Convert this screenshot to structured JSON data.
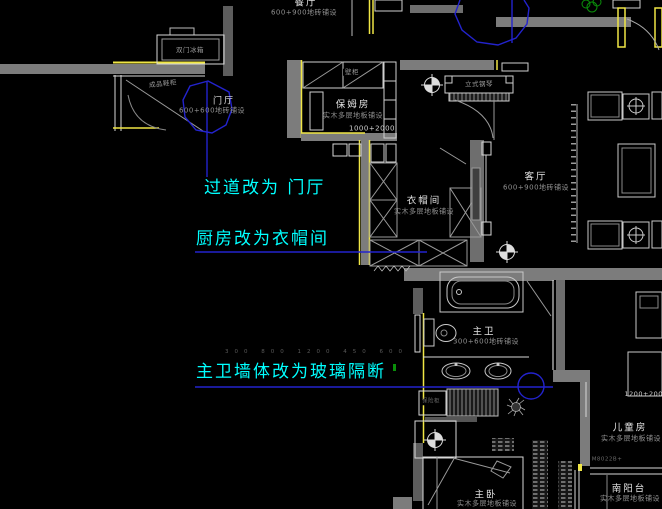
{
  "colors": {
    "background": "#000000",
    "wall_gray": "#7c7c7c",
    "line_white": "#d9d9d9",
    "accent_yellow": "#f0e645",
    "annotation_cyan": "#00ffff",
    "leader_blue": "#2323cd",
    "plant_green": "#0a8f0a"
  },
  "annotations": {
    "corridor_note": "过道改为 门厅",
    "kitchen_note": "厨房改为衣帽间",
    "bath_note": "主卫墙体改为玻璃隔断",
    "faint_dims": "300 800 1200 450 600"
  },
  "rooms": {
    "dining": {
      "name": "餐厅",
      "finish": "600+900地砖铺设"
    },
    "entry": {
      "name": "门厅",
      "finish": "600+600地砖铺设"
    },
    "nanny": {
      "name": "保姆房",
      "finish": "实木多层地板铺设",
      "dim": "1000+2000"
    },
    "cloak": {
      "name": "衣帽间",
      "finish": "实木多层地板铺设"
    },
    "living": {
      "name": "客厅",
      "finish": "600+900地砖铺设"
    },
    "master_bath": {
      "name": "主卫",
      "finish": "300+600地砖铺设"
    },
    "children": {
      "name": "儿童房",
      "finish": "实木多层地板铺设",
      "dim": "1200+2000",
      "door_code": "M8022B+"
    },
    "balcony": {
      "name": "南阳台",
      "finish": "实木多层地板铺设"
    },
    "master": {
      "name": "主卧",
      "finish": "实木多层地板铺设"
    }
  },
  "fixtures": {
    "fridge": "双门冰箱",
    "shoe_cabinet": "成品鞋柜",
    "wall_cabinet": "壁柜",
    "piano": "立式钢琴",
    "cabinet_small": "保险柜"
  }
}
